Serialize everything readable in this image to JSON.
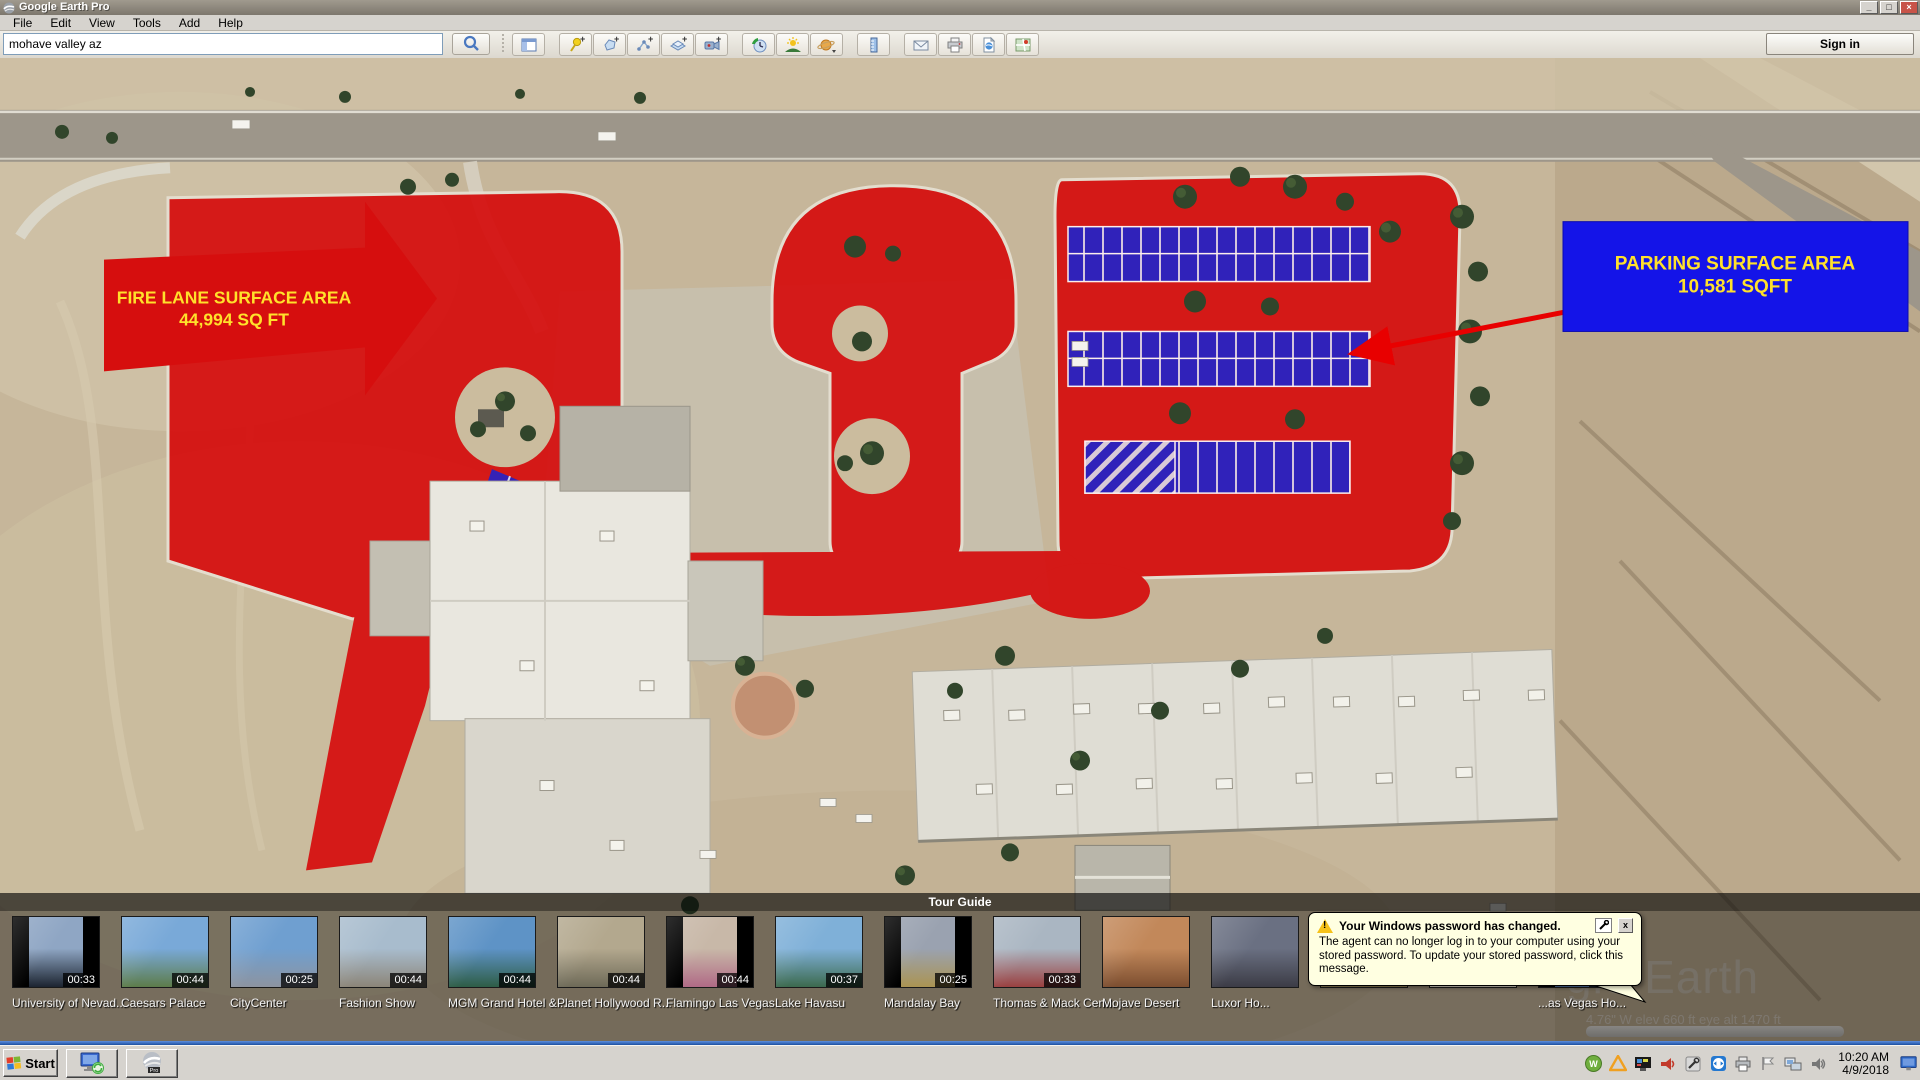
{
  "window": {
    "title": "Google Earth Pro",
    "minimize": "_",
    "maximize": "□",
    "close": "×"
  },
  "menu": {
    "items": [
      "File",
      "Edit",
      "View",
      "Tools",
      "Add",
      "Help"
    ]
  },
  "toolbar": {
    "search_value": "mohave valley az",
    "sign_in_label": "Sign in",
    "tools": [
      "search",
      "sidebar",
      "placemark",
      "polygon",
      "path",
      "image-overlay",
      "record-tour",
      "historical-imagery",
      "sunlight",
      "planets",
      "ruler",
      "email",
      "print",
      "save-image",
      "view-in-maps"
    ]
  },
  "map": {
    "fire_lane_label": {
      "line1": "FIRE LANE SURFACE AREA",
      "line2": "44,994 SQ FT"
    },
    "parking_label": {
      "line1": "PARKING SURFACE AREA",
      "line2": "10,581 SQFT"
    },
    "watermark": "gle Earth",
    "status_fragment": "4.76\" W    elev  660 ft    eye alt  1470 ft"
  },
  "tour_guide": {
    "title": "Tour Guide",
    "items": [
      {
        "label": "University of Nevad...",
        "time": "00:33",
        "tint1": "#8fa6c4",
        "tint2": "#1c2430",
        "boxed": true
      },
      {
        "label": "Caesars Palace",
        "time": "00:44",
        "tint1": "#79a9d8",
        "tint2": "#5d7c4a",
        "boxed": false
      },
      {
        "label": "CityCenter",
        "time": "00:25",
        "tint1": "#6f9fd0",
        "tint2": "#8d94a0",
        "boxed": false
      },
      {
        "label": "Fashion Show",
        "time": "00:44",
        "tint1": "#a8bccd",
        "tint2": "#8c8578",
        "boxed": false
      },
      {
        "label": "MGM Grand Hotel & ...",
        "time": "00:44",
        "tint1": "#5e93c6",
        "tint2": "#2e5d46",
        "boxed": false
      },
      {
        "label": "Planet Hollywood R...",
        "time": "00:44",
        "tint1": "#b3a88e",
        "tint2": "#6e6a58",
        "boxed": false
      },
      {
        "label": "Flamingo Las Vegas",
        "time": "00:44",
        "tint1": "#c8b8a8",
        "tint2": "#b06a86",
        "boxed": true
      },
      {
        "label": "Lake Havasu",
        "time": "00:37",
        "tint1": "#7fb0d8",
        "tint2": "#3c6a4e",
        "boxed": false
      },
      {
        "label": "Mandalay Bay",
        "time": "00:25",
        "tint1": "#9aa2b0",
        "tint2": "#ab9452",
        "boxed": true
      },
      {
        "label": "Thomas & Mack Cen...",
        "time": "00:33",
        "tint1": "#aab6c2",
        "tint2": "#9a4040",
        "boxed": false
      },
      {
        "label": "Mojave Desert",
        "time": "",
        "tint1": "#c2885a",
        "tint2": "#7c4e30",
        "boxed": false
      },
      {
        "label": "Luxor Ho...",
        "time": "",
        "tint1": "#6a7082",
        "tint2": "#3c3c46",
        "boxed": false
      },
      {
        "label": "",
        "time": "",
        "tint1": "#3c5c88",
        "tint2": "#8a7a50",
        "boxed": false
      },
      {
        "label": "",
        "time": "",
        "tint1": "#88b0d8",
        "tint2": "#cfc8ba",
        "boxed": false
      },
      {
        "label": "...as Vegas Ho...",
        "time": "00:37",
        "tint1": "#252c3c",
        "tint2": "#4c6a96",
        "boxed": true
      }
    ]
  },
  "balloon": {
    "title": "Your Windows password has changed.",
    "body": "The agent can no longer log in to your computer using your stored password. To update your stored password, click this message.",
    "close": "x"
  },
  "taskbar": {
    "start_label": "Start",
    "apps": [
      "remote-desktop",
      "google-earth-pro"
    ],
    "tray_time": "10:20 AM",
    "tray_date": "4/9/2018"
  },
  "colors": {
    "fire_red": "#d60e0e",
    "label_blue": "#1414e8",
    "parking_blue": "#2323c8",
    "label_yellow": "#ffe12b",
    "balloon_bg": "#ffffe1",
    "taskbar_bg": "#d6d3ce"
  }
}
